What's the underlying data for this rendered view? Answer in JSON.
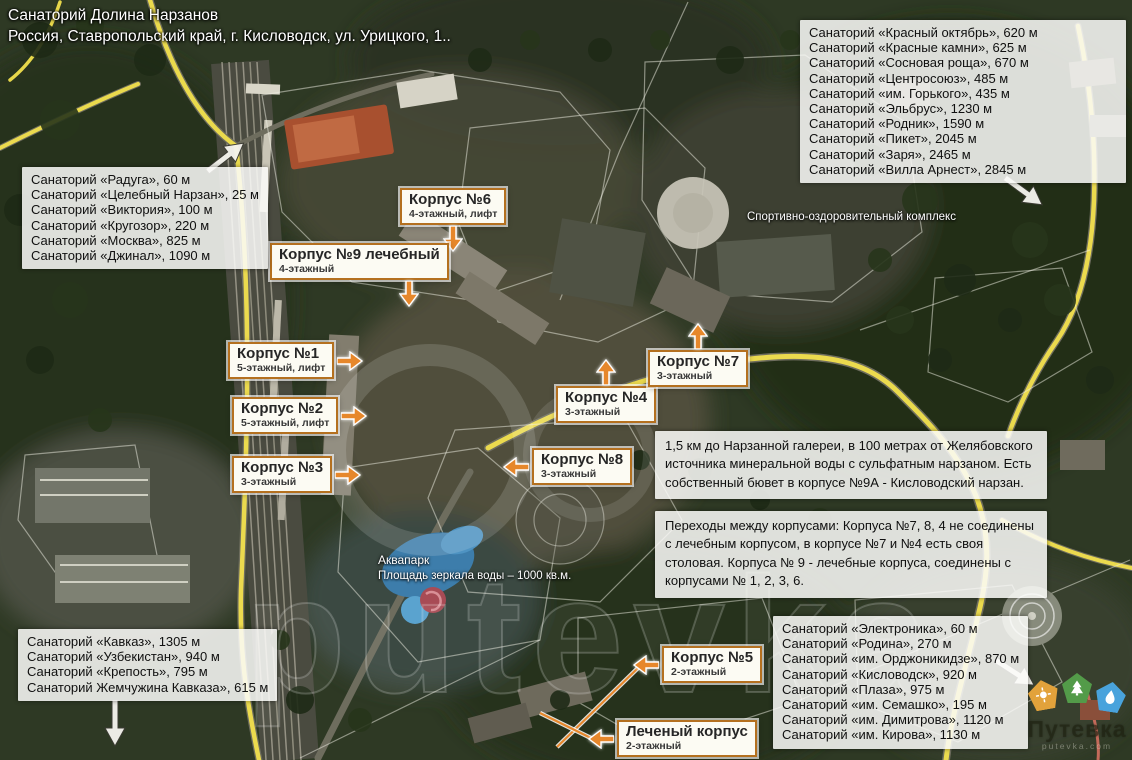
{
  "title": {
    "line1": "Санаторий Долина Нарзанов",
    "line2": "Россия, Ставропольский край, г. Кисловодск, ул. Урицкого, 1.."
  },
  "lists": {
    "top_left": {
      "items": [
        "Санаторий «Радуга», 60 м",
        "Санаторий «Целебный Нарзан», 25 м",
        "Санаторий «Виктория», 100 м",
        "Санаторий «Кругозор», 220 м",
        "Санаторий «Москва», 825 м",
        "Санаторий «Джинал», 1090 м"
      ]
    },
    "top_right": {
      "items": [
        "Санаторий «Красный октябрь», 620 м",
        "Санаторий «Красные камни», 625 м",
        "Санаторий «Сосновая роща», 670 м",
        "Санаторий «Центросоюз», 485 м",
        "Санаторий «им. Горького», 435 м",
        "Санаторий «Эльбрус», 1230 м",
        "Санаторий «Родник», 1590 м",
        "Санаторий «Пикет», 2045 м",
        "Санаторий «Заря», 2465 м",
        "Санаторий «Вилла Арнест», 2845 м"
      ]
    },
    "bottom_left": {
      "items": [
        "Санаторий «Кавказ», 1305 м",
        "Санаторий «Узбекистан», 940 м",
        "Санаторий «Крепость», 795 м",
        "Санаторий Жемчужина Кавказа», 615 м"
      ]
    },
    "bottom_right": {
      "items": [
        "Санаторий «Электроника», 60 м",
        "Санаторий «Родина», 270 м",
        "Санаторий «им. Орджоникидзе», 870 м",
        "Санаторий «Кисловодск», 920 м",
        "Санаторий «Плаза», 975 м",
        "Санаторий «им. Семашко», 195 м",
        "Санаторий «им. Димитрова», 1120 м",
        "Санаторий «им. Кирова», 1130 м"
      ]
    }
  },
  "info_boxes": {
    "narzan": "1,5 км до Нарзанной галереи,  в 100 метрах от Желябовского источника минеральной воды с сульфатным нарзаном. Есть собственный бювет в корпусе №9А - Кисловодский нарзан.",
    "transitions": "Переходы между корпусами: Корпуса №7, 8, 4 не соединены с лечебным корпусом, в корпусе №7 и №4 есть своя столовая. Корпуса № 9 - лечебные корпуса, соединены с корпусами № 1, 2, 3, 6."
  },
  "building_labels": [
    {
      "title": "Корпус №6",
      "subtitle": "4-этажный, лифт",
      "arrow": "down"
    },
    {
      "title": "Корпус №9 лечебный",
      "subtitle": "4-этажный",
      "arrow": "down"
    },
    {
      "title": "Корпус №1",
      "subtitle": "5-этажный, лифт",
      "arrow": "right"
    },
    {
      "title": "Корпус №2",
      "subtitle": "5-этажный, лифт",
      "arrow": "right"
    },
    {
      "title": "Корпус №3",
      "subtitle": "3-этажный",
      "arrow": "right"
    },
    {
      "title": "Корпус №4",
      "subtitle": "3-этажный",
      "arrow": "up"
    },
    {
      "title": "Корпус №7",
      "subtitle": "3-этажный",
      "arrow": "up"
    },
    {
      "title": "Корпус №8",
      "subtitle": "3-этажный",
      "arrow": "left"
    },
    {
      "title": "Корпус №5",
      "subtitle": "2-этажный",
      "arrow": "left"
    },
    {
      "title": "Леченый корпус",
      "subtitle": "2-этажный",
      "arrow": "left"
    }
  ],
  "map_labels": {
    "sport_complex": "Спортивно-оздоровительный комплекс",
    "aquapark_title": "Аквапарк",
    "aquapark_subtitle": "Площадь зеркала воды – 1000 кв.м."
  },
  "watermark": {
    "map_text": "putevka",
    "logo_text": "Путевка",
    "logo_sub": "putevka.com",
    "badges": [
      "sun",
      "tree",
      "water-drop"
    ]
  },
  "colors": {
    "label_border": "#b4701f",
    "arrow_orange": "#e6872b",
    "road_yellow": "#f1e04d",
    "box_background": "#fcfbf3"
  }
}
